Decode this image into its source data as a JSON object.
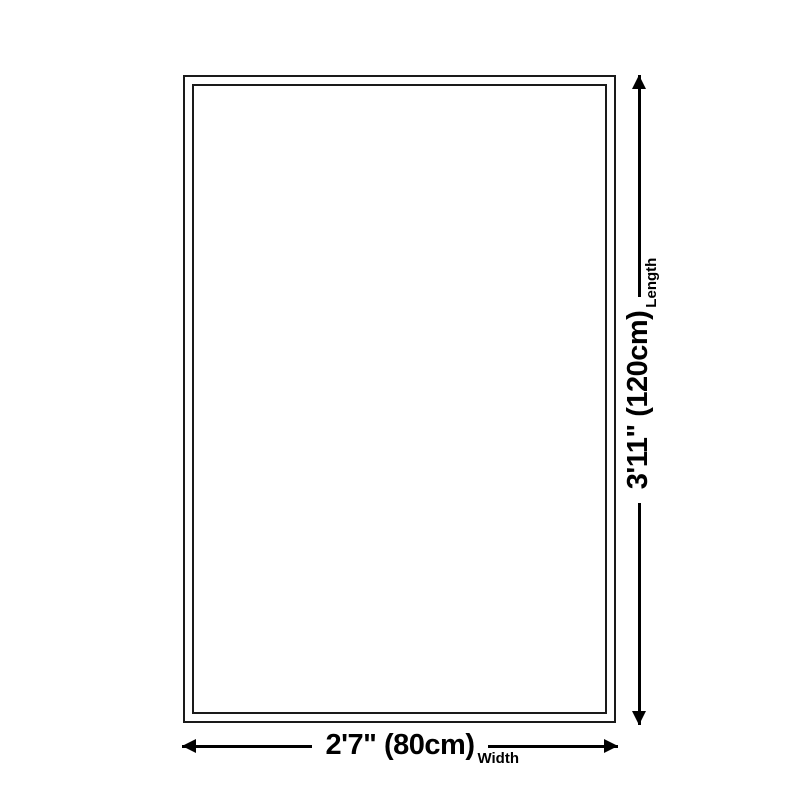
{
  "diagram": {
    "dimensions": {
      "length": {
        "value": "3'11\" (120cm)",
        "label": "Length"
      },
      "width": {
        "value": "2'7\" (80cm)",
        "label": "Width"
      }
    },
    "icons": {
      "length_start": "arrow-down-icon",
      "length_end": "arrow-up-icon",
      "width_start": "arrow-left-icon",
      "width_end": "arrow-right-icon"
    },
    "colors": {
      "background": "#ffffff",
      "outline_border": "#1a1a1a",
      "line": "#000000",
      "text": "#000000"
    }
  }
}
